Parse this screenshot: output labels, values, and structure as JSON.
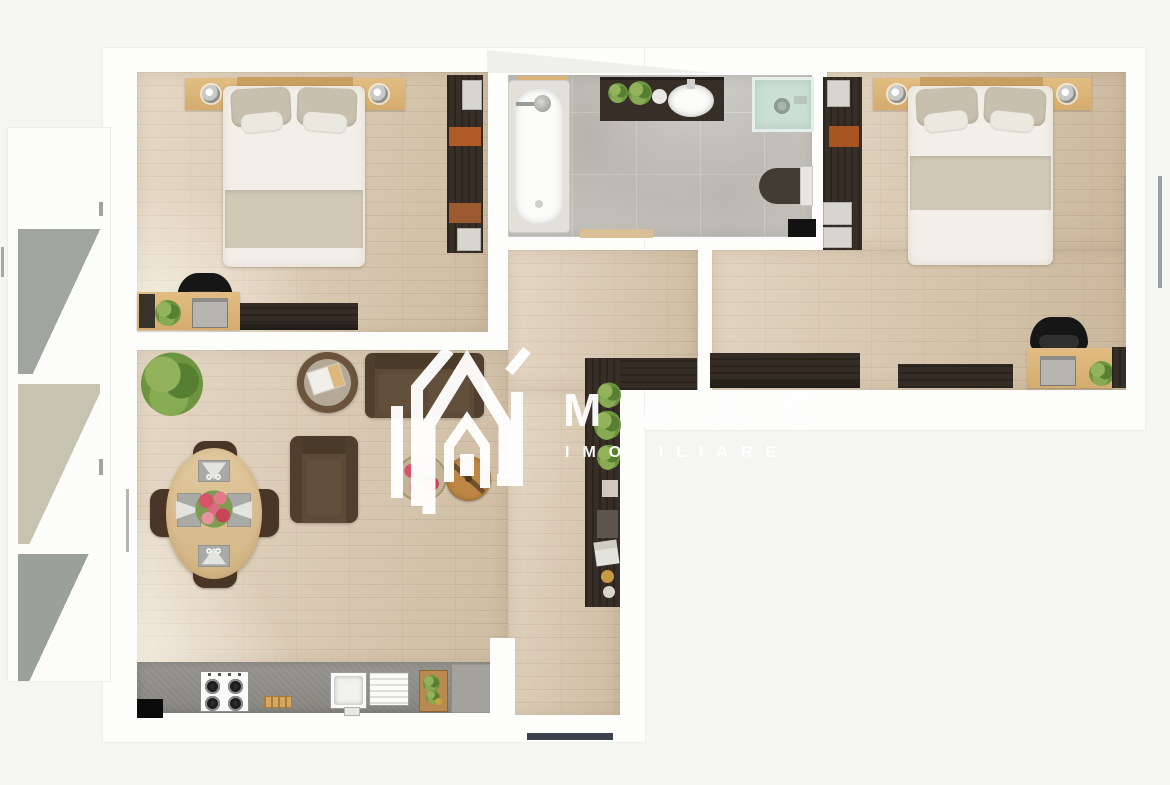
{
  "watermark": {
    "brand": "MAAC",
    "tagline": "IMOBILIARE",
    "logo": "maac-house-monogram"
  },
  "palette": {
    "page_bg": "#f5f5f4",
    "sheet_white": "#fdfdfc",
    "wood_floor": "#d9c6ab",
    "bath_tile_gray": "#c8c5bf",
    "balcony_tile_gray": "#9aa19b",
    "balcony_tile_beige": "#bfbdab",
    "dark_furniture": "#372f27",
    "light_wood": "#dcb57a",
    "sofa_brown": "#5d4a37",
    "kitchen_counter_gray": "#8e8d87",
    "plant_green": "#6d9440",
    "shelf_accent_orange": "#b05a26",
    "flower_pink": "#d8526a",
    "watermark_white": "#ffffff",
    "entrance_door_dark": "#3b424b"
  },
  "plan": {
    "type": "apartment-floor-plan-top-view",
    "rooms": [
      {
        "id": "bedroom-1",
        "floor": "wood",
        "furniture": [
          "double-bed",
          "headboard",
          "nightstand-left",
          "nightstand-right",
          "lamp",
          "lamp",
          "wardrobe",
          "desk",
          "office-chair",
          "printer",
          "plant",
          "tv-stand"
        ]
      },
      {
        "id": "bathroom",
        "floor": "gray-tile",
        "furniture": [
          "bathtub",
          "vanity-counter",
          "oval-sink",
          "plants",
          "shower-cabin",
          "toilet",
          "black-mat",
          "door-threshold"
        ]
      },
      {
        "id": "bedroom-2",
        "floor": "wood",
        "furniture": [
          "double-bed",
          "headboard",
          "nightstand-left",
          "nightstand-right",
          "lamp",
          "lamp",
          "wardrobe",
          "sideboard",
          "dresser",
          "desk",
          "office-chair",
          "printer",
          "plant"
        ]
      },
      {
        "id": "hallway",
        "floor": "wood",
        "furniture": [
          "console-sideboard",
          "shelf-column",
          "tall-plant",
          "decor-items",
          "entrance-door"
        ]
      },
      {
        "id": "living-room",
        "floor": "wood",
        "furniture": [
          "sofa",
          "armchair",
          "round-side-table",
          "book",
          "round-coffee-table",
          "round-flower-rug",
          "oval-dining-table",
          "dining-chair-north",
          "dining-chair-south",
          "dining-chair-west",
          "dining-chair-east",
          "placemats",
          "flower-bouquet",
          "potted-plant"
        ]
      },
      {
        "id": "kitchen",
        "floor": "wood",
        "furniture": [
          "countertop",
          "gas-hob",
          "bread-board",
          "sink-basin",
          "drainer",
          "cutting-board-vegetables",
          "end-cabinet",
          "black-floor-mat"
        ]
      },
      {
        "id": "balcony",
        "floor": "gray-beige-tile",
        "furniture": []
      }
    ],
    "openings": [
      "window-right-wall-bedroom-2",
      "balcony-door-living-room",
      "balcony-rail-marks",
      "bathroom-door-threshold",
      "entrance-door-south"
    ]
  }
}
